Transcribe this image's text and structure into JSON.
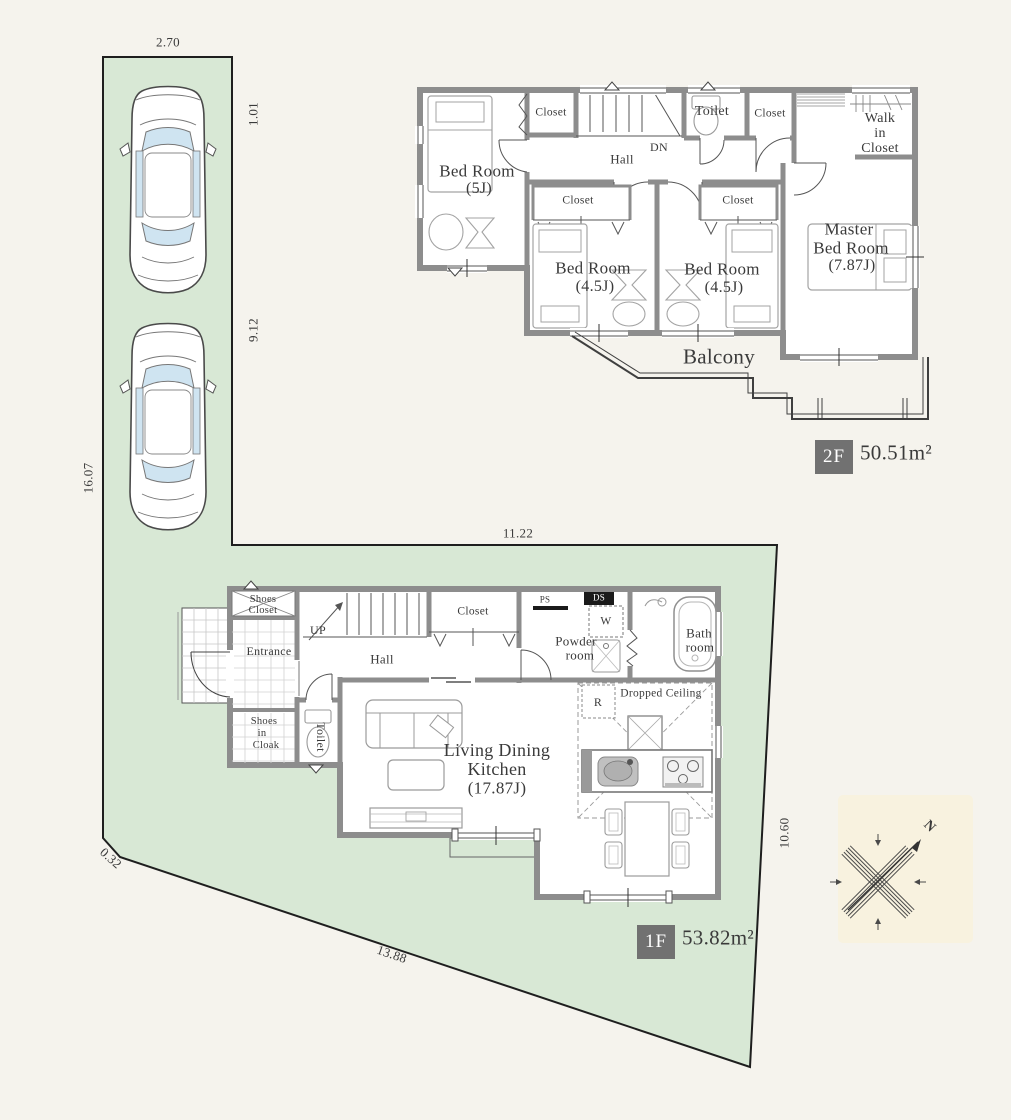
{
  "site": {
    "dim_top": "2.70",
    "dim_right_upper": "1.01",
    "dim_right_lower": "9.12",
    "dim_left": "16.07",
    "dim_width": "11.22",
    "dim_right": "10.60",
    "dim_bottom": "13.88",
    "dim_corner": "0.32"
  },
  "floor2": {
    "badge": "2F",
    "area": "50.51m²",
    "bedroom5_name": "Bed Room",
    "bedroom5_size": "(5J)",
    "closet_top_left": "Closet",
    "stairs_down": "DN",
    "hall": "Hall",
    "toilet": "Toilet",
    "closet_top_right": "Closet",
    "wic_line1": "Walk",
    "wic_line2": "in",
    "wic_line3": "Closet",
    "closet_a": "Closet",
    "closet_b": "Closet",
    "bedroom_a_name": "Bed Room",
    "bedroom_a_size": "(4.5J)",
    "bedroom_b_name": "Bed Room",
    "bedroom_b_size": "(4.5J)",
    "master_line1": "Master",
    "master_line2": "Bed Room",
    "master_size": "(7.87J)",
    "balcony": "Balcony"
  },
  "floor1": {
    "badge": "1F",
    "area": "53.82m²",
    "shoes_closet_line1": "Shoes",
    "shoes_closet_line2": "Closet",
    "entrance": "Entrance",
    "stairs_up": "UP",
    "hall": "Hall",
    "closet": "Closet",
    "ps": "PS",
    "ds": "DS",
    "washer": "W",
    "powder_line1": "Powder",
    "powder_line2": "room",
    "bath_line1": "Bath",
    "bath_line2": "room",
    "cloak_line1": "Shoes",
    "cloak_line2": "in",
    "cloak_line3": "Cloak",
    "toilet": "Toilet",
    "ldk_line1": "Living Dining",
    "ldk_line2": "Kitchen",
    "ldk_size": "(17.87J)",
    "fridge": "R",
    "dropped_ceiling": "Dropped Ceiling"
  },
  "compass": {
    "north": "N"
  },
  "colors": {
    "background": "#f5f3ed",
    "site_green": "#d8e8d5",
    "wall_gray": "#8d8d8d",
    "badge_gray": "#717171",
    "glass_blue": "#cfe4f1"
  }
}
